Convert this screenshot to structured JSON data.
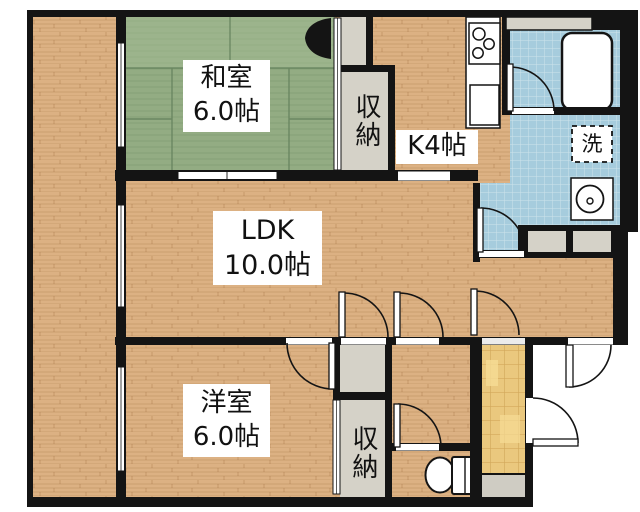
{
  "floorplan": {
    "title": "2LDK apartment floor plan",
    "labels": {
      "washitsu_name": "和室",
      "washitsu_size": "6.0帖",
      "ldk_name": "LDK",
      "ldk_size": "10.0帖",
      "yoshitsu_name": "洋室",
      "yoshitsu_size": "6.0帖",
      "kitchen": "K4帖",
      "closet_upper": "収納",
      "closet_lower": "収納",
      "laundry": "洗"
    },
    "colors": {
      "wood": "#dcb183",
      "tatami": "#93ac83",
      "tatami_light": "#a9bf97",
      "closet": "#d5d2c8",
      "water": "#a6ccdd",
      "tile": "#eac87e",
      "wall": "#141414",
      "step": "#cfccc3"
    },
    "icons": [
      "stove-icon",
      "sink-icon",
      "bathtub-icon",
      "washing-machine-icon",
      "washbasin-icon",
      "toilet-icon",
      "door-swing-icon",
      "bifold-door-icon",
      "window-icon",
      "sliding-door-icon"
    ]
  }
}
